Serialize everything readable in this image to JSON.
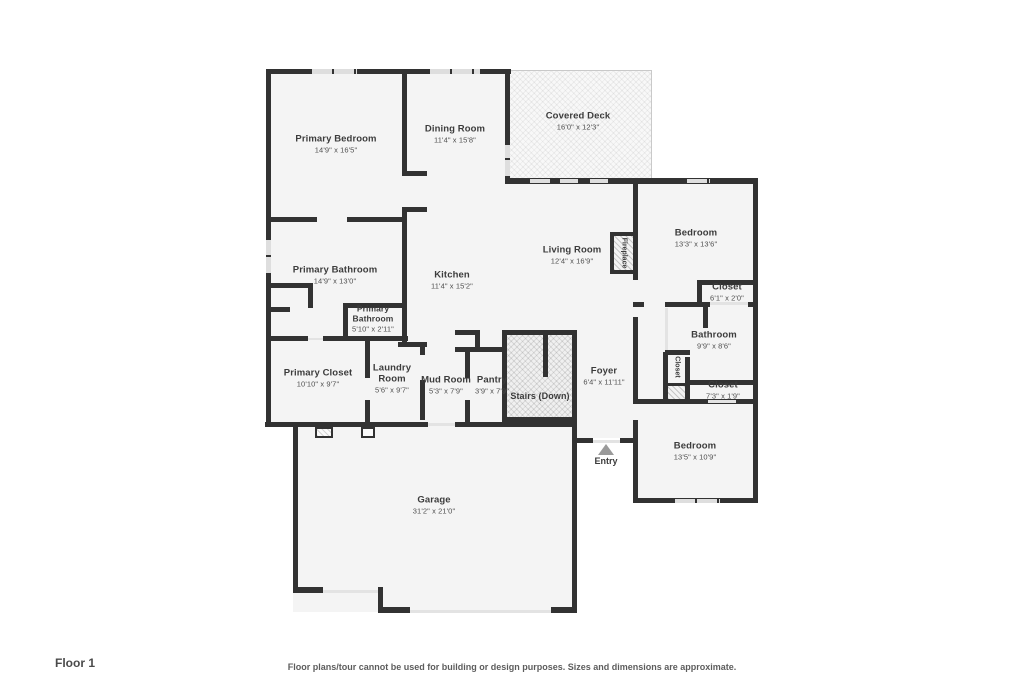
{
  "rooms": {
    "primary_bedroom": {
      "name": "Primary Bedroom",
      "dims": "14'9\" x 16'5\""
    },
    "dining_room": {
      "name": "Dining Room",
      "dims": "11'4\" x 15'8\""
    },
    "covered_deck": {
      "name": "Covered Deck",
      "dims": "16'0\" x 12'3\""
    },
    "bedroom_ne": {
      "name": "Bedroom",
      "dims": "13'3\" x 13'6\""
    },
    "living_room": {
      "name": "Living Room",
      "dims": "12'4\" x 16'9\""
    },
    "kitchen": {
      "name": "Kitchen",
      "dims": "11'4\" x 15'2\""
    },
    "primary_bathroom": {
      "name": "Primary Bathroom",
      "dims": "14'9\" x 13'0\""
    },
    "closet_ne": {
      "name": "Closet",
      "dims": "6'1\" x 2'0\""
    },
    "primary_bathroom_wc": {
      "name": "Primary Bathroom",
      "dims": "5'10\" x 2'11\""
    },
    "bathroom": {
      "name": "Bathroom",
      "dims": "9'9\" x 8'6\""
    },
    "closet_e": {
      "name": "Closet",
      "dims": "7'3\" x 1'9\""
    },
    "primary_closet": {
      "name": "Primary Closet",
      "dims": "10'10\" x 9'7\""
    },
    "laundry_room": {
      "name": "Laundry Room",
      "dims": "5'6\" x 9'7\""
    },
    "mud_room": {
      "name": "Mud Room",
      "dims": "5'3\" x 7'9\""
    },
    "pantry": {
      "name": "Pantry",
      "dims": "3'9\" x 7'9\""
    },
    "foyer": {
      "name": "Foyer",
      "dims": "6'4\" x 11'11\""
    },
    "bedroom_se": {
      "name": "Bedroom",
      "dims": "13'5\" x 10'9\""
    },
    "garage": {
      "name": "Garage",
      "dims": "31'2\" x 21'0\""
    },
    "stairs": {
      "name": "Stairs (Down)"
    },
    "entry": {
      "name": "Entry"
    },
    "fireplace": {
      "name": "Fireplace"
    },
    "closet_vertical": {
      "name": "Closet"
    }
  },
  "footer": {
    "floor_label": "Floor 1",
    "disclaimer": "Floor plans/tour cannot be used for building or design purposes. Sizes and dimensions are approximate."
  },
  "colors": {
    "wall": "#323232",
    "room_fill": "#f4f4f4",
    "window": "#dedede",
    "text": "#3c3c3c",
    "entry_arrow": "#9a9a9a"
  }
}
